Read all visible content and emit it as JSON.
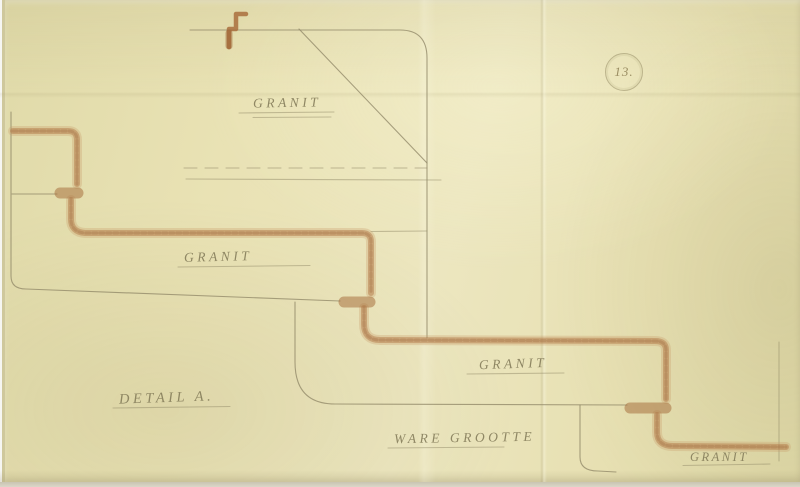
{
  "sheet": {
    "number": "13."
  },
  "labels": {
    "granit_top": "GRANIT",
    "granit_left": "GRANIT",
    "granit_right": "GRANIT",
    "granit_bottom": "GRANIT",
    "detail": "DETAIL A.",
    "scale_note": "WARE GROOTTE"
  },
  "colors": {
    "paper": "#e9e2b4",
    "paper-edge": "#cfc89c",
    "pencil": "#938b6a",
    "crayon": "#b37c4a",
    "crayon-light": "#cb9e6e",
    "ink-label": "#837b59"
  }
}
